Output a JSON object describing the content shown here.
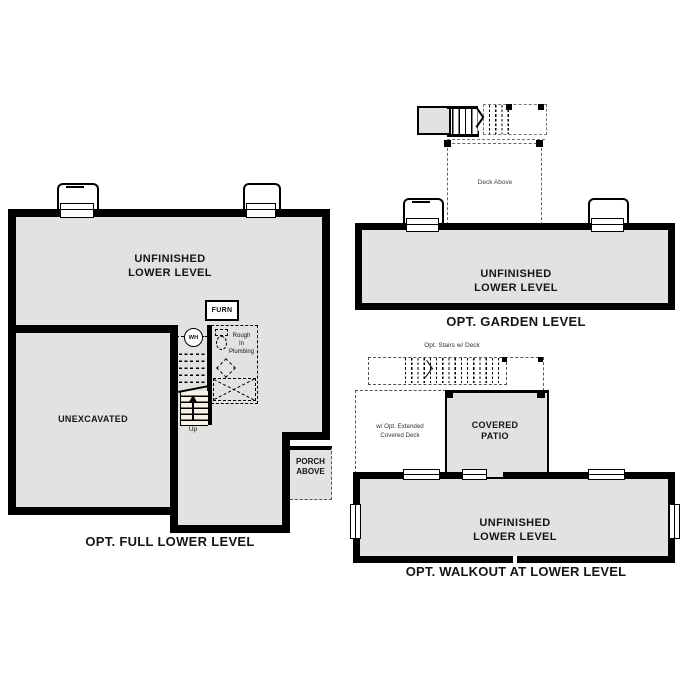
{
  "colors": {
    "floor": "#e3e2e0",
    "wall": "#000000",
    "stair_fill": "#f6f1e5",
    "background": "#ffffff"
  },
  "plans": {
    "full_lower": {
      "caption": "OPT. FULL LOWER LEVEL",
      "room_line1": "UNFINISHED",
      "room_line2": "LOWER LEVEL",
      "unexcavated": "UNEXCAVATED",
      "furnace": "FURN",
      "water_heater": "WH",
      "plumbing_line1": "Rough",
      "plumbing_line2": "In",
      "plumbing_line3": "Plumbing",
      "stairs_up": "Up",
      "porch_line1": "PORCH",
      "porch_line2": "ABOVE"
    },
    "garden": {
      "caption": "OPT. GARDEN LEVEL",
      "room_line1": "UNFINISHED",
      "room_line2": "LOWER LEVEL",
      "deck": "Deck Above"
    },
    "walkout": {
      "caption": "OPT. WALKOUT AT LOWER LEVEL",
      "room_line1": "UNFINISHED",
      "room_line2": "LOWER LEVEL",
      "opt_stairs": "Opt. Stairs w/ Deck",
      "patio_line1": "COVERED",
      "patio_line2": "PATIO",
      "ext_deck_line1": "w/ Opt. Extended",
      "ext_deck_line2": "Covered Deck"
    }
  }
}
